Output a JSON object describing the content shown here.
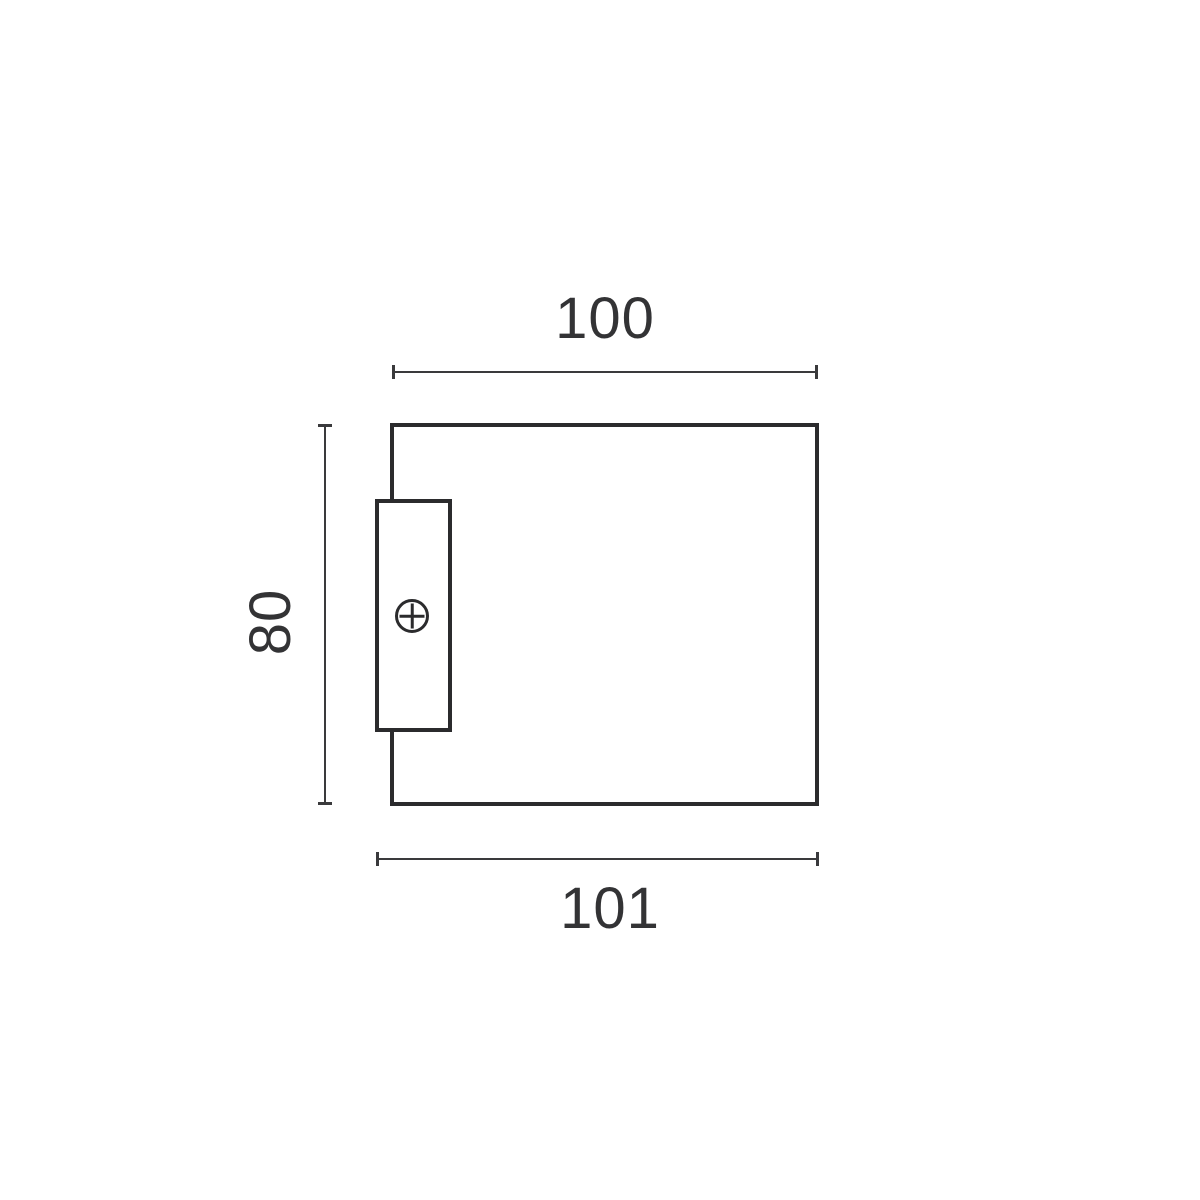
{
  "diagram": {
    "kind": "technical-dimension-drawing",
    "colors": {
      "background": "#ffffff",
      "line": "#2b2b2d",
      "dimension_line": "#3a3a3c",
      "text": "#333335"
    },
    "dimensions": {
      "width_top": "100",
      "height_left": "80",
      "width_bottom": "101"
    },
    "icons": {
      "screw": "plus-circle"
    }
  }
}
